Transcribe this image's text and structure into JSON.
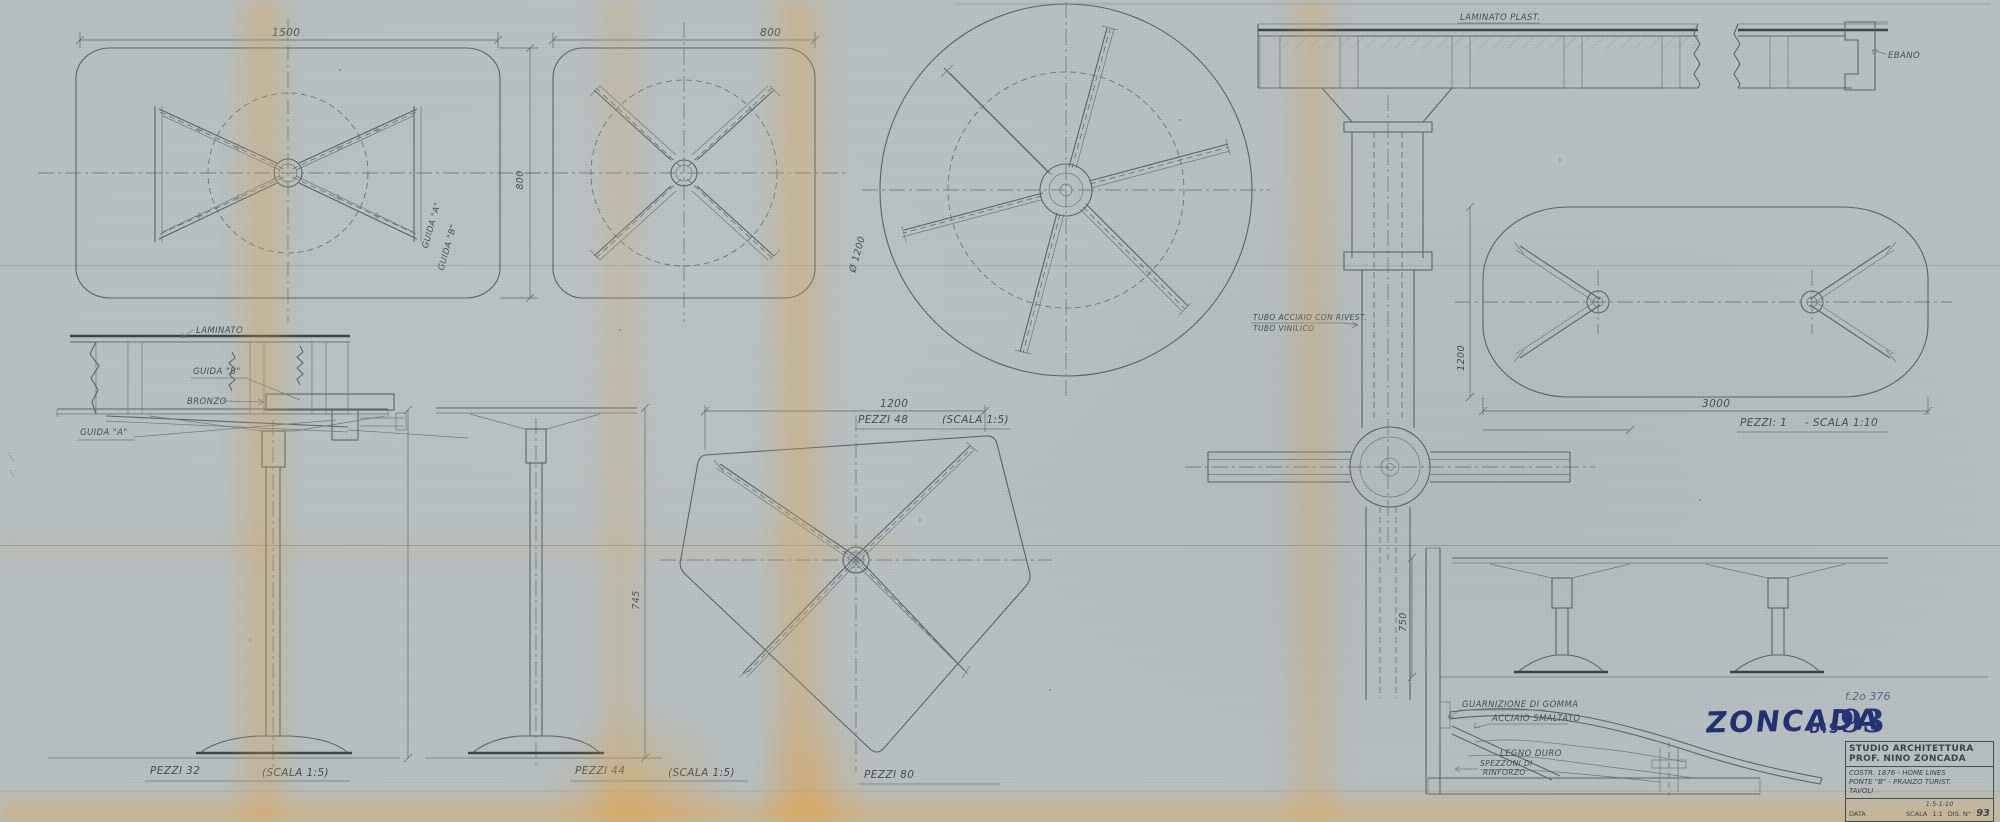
{
  "sheet": {
    "signature": "ZONCADA",
    "stamp": {
      "dis": "DIS",
      "number": "93"
    },
    "pencil_note": "f.2o 376"
  },
  "title_block": {
    "studio_line1": "STUDIO ARCHITETTURA",
    "studio_line2": "PROF. NINO ZONCADA",
    "project_line1": "COSTR. 1876 - HOME LINES",
    "project_line2": "PONTE \"B\" - PRANZO TURIST.",
    "project_line3": "TAVOLI",
    "data_label": "DATA",
    "scala_label": "SCALA",
    "scala_range": "1:5-1:10",
    "scala_unit": "1:1",
    "dis_label": "DIS. N°",
    "dis_number": "93"
  },
  "plans": {
    "rect_table": {
      "dim_length": "1500",
      "dim_width": "800",
      "guida_a": "GUIDA \"A\"",
      "guida_b": "GUIDA \"B\""
    },
    "square_table": {
      "dim_width": "800"
    },
    "round_table": {
      "dim_diameter": "Ø 1200",
      "pezzi": "PEZZI 48",
      "scala": "(SCALA 1:5)"
    },
    "pentagon_table": {
      "dim_width": "1200",
      "pezzi": "PEZZI 80"
    },
    "oval_table": {
      "dim_length": "3000",
      "dim_width": "1200",
      "pezzi": "PEZZI: 1",
      "scala": "- SCALA 1:10"
    }
  },
  "elevations": {
    "small_table": {
      "pezzi": "PEZZI 32",
      "scala": "(SCALA 1:5)"
    },
    "medium_table": {
      "pezzi": "PEZZI 44",
      "scala": "(SCALA 1:5)",
      "dim_height": "745"
    },
    "long_table": {
      "dim_height": "750"
    }
  },
  "details": {
    "edge_section": {
      "laminato": "LAMINATO",
      "guida_b": "GUIDA \"B\"",
      "bronzo": "BRONZO",
      "guida_a": "GUIDA \"A\""
    },
    "top_section": {
      "laminato_plast": "LAMINATO PLAST.",
      "ebano": "EBANO"
    },
    "column": {
      "label_line1": "TUBO ACCIAIO CON RIVEST.",
      "label_line2": "TUBO VINILICO"
    },
    "base": {
      "guarnizione": "GUARNIZIONE DI GOMMA",
      "acciaio": "ACCIAIO SMALTATO",
      "legno": "LEGNO DURO",
      "rinforzo_line1": "SPEZZONI DI",
      "rinforzo_line2": "RINFORZO"
    }
  }
}
